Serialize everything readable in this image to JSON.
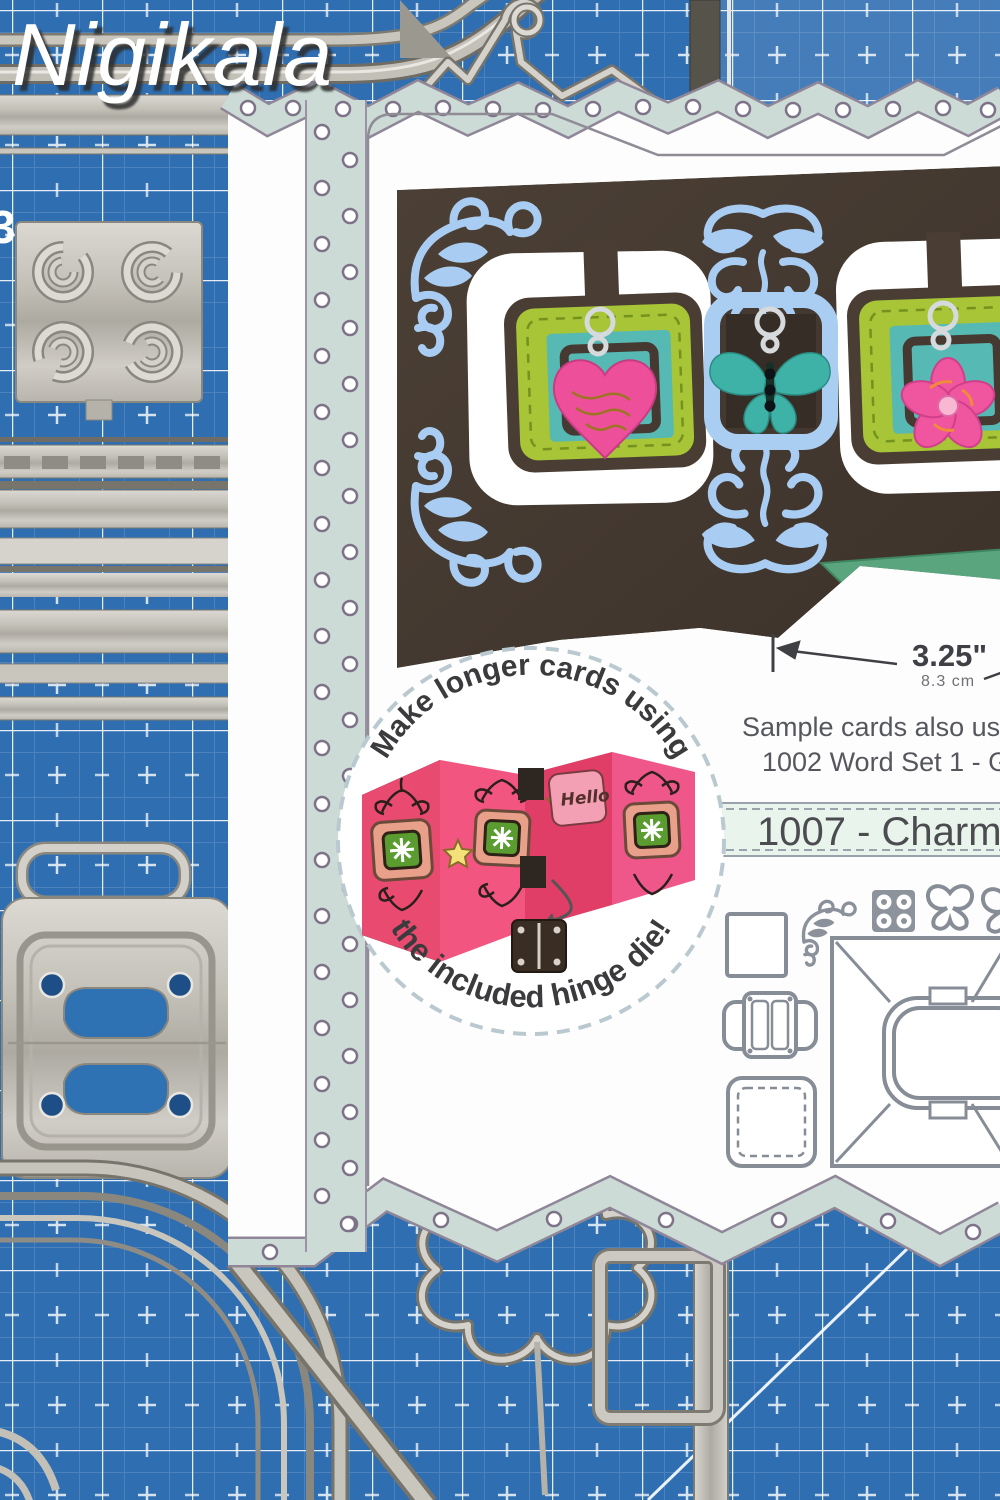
{
  "watermark": {
    "text": "Nigikala"
  },
  "mat": {
    "corner_label": "3"
  },
  "package": {
    "note_line1": "Sample cards also us",
    "note_line2": "1002 Word Set 1 - Gre",
    "product_title": "1007 - Charm A",
    "card": {
      "congrats_script": "congr",
      "dimension_in": "3.25\"",
      "dimension_cm": "8.3 cm"
    },
    "inset": {
      "top_text": "Make longer cards using",
      "bottom_text": "the included hinge die!",
      "hello": "Hello"
    }
  },
  "colors": {
    "mat_blue": "#2f6fb1",
    "mint": "#ccdbd6",
    "mint_banner": "#e9f4ec",
    "card_brown": "#46392f",
    "flourish_blue": "#a9cdf2",
    "lime": "#a8c437",
    "teal_square": "#57b9b3",
    "frame_blue": "#aacdf2",
    "heart_pink": "#ee4f9a",
    "banner_green": "#5aa57e",
    "congrats_coral": "#e8917b",
    "accordion_pink": "#e94a70",
    "die_outline_gray": "#878d96",
    "metal_gray": "#c7c4bc"
  }
}
